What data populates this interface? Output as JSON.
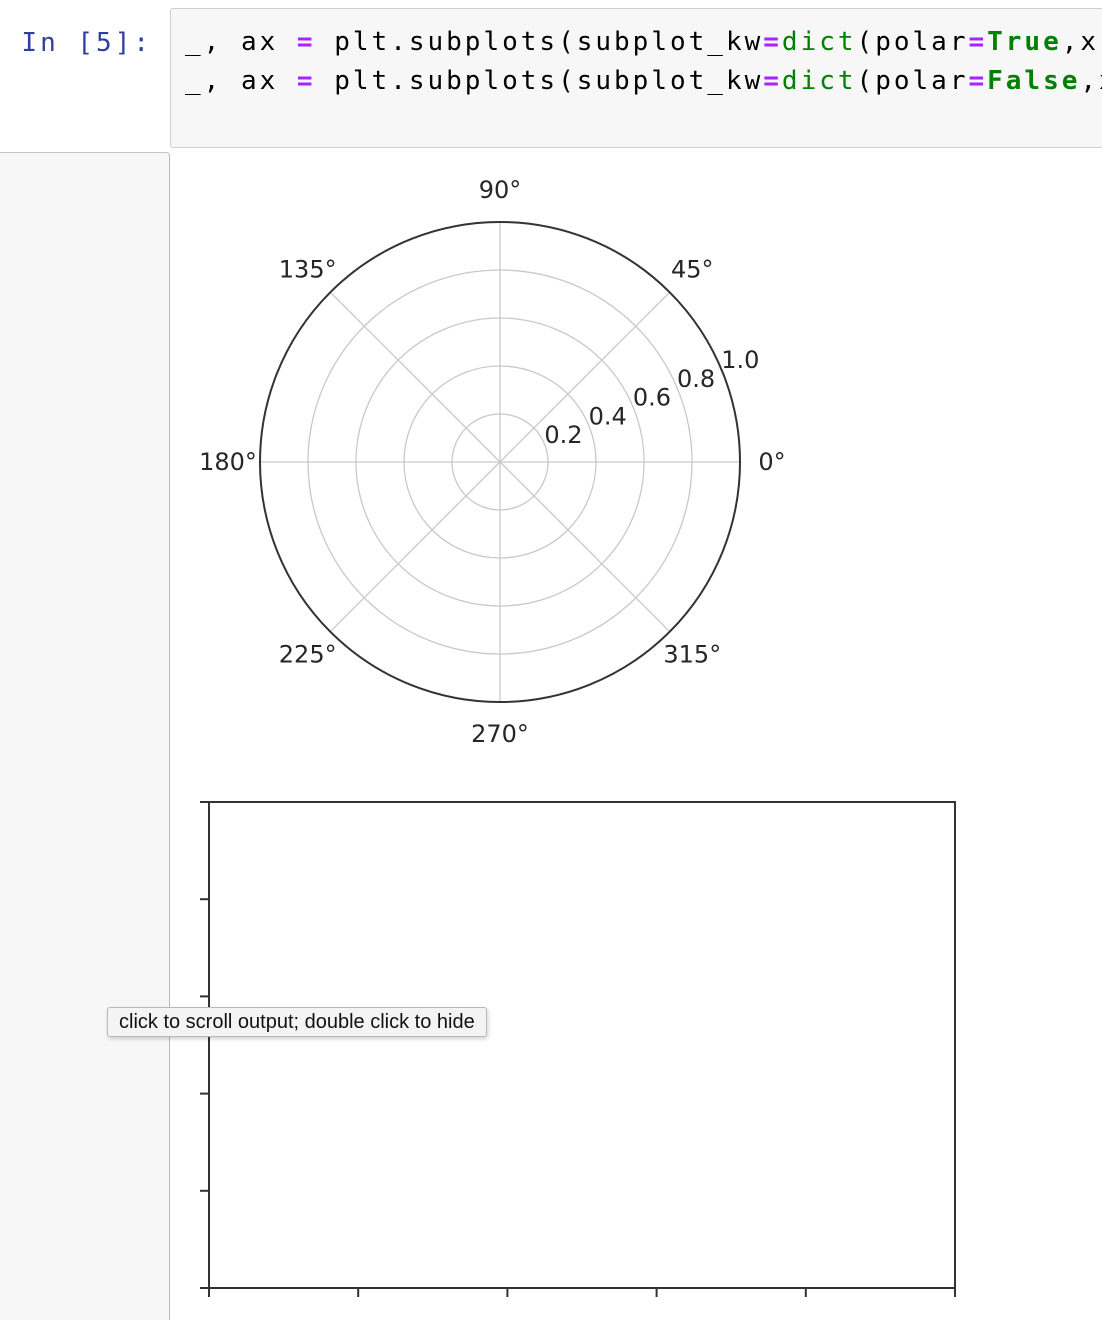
{
  "cell": {
    "prompt": "In [5]:",
    "code_lines": [
      [
        {
          "t": "_, ax ",
          "c": "plain"
        },
        {
          "t": "=",
          "c": "op"
        },
        {
          "t": " plt.subplots(subplot_kw",
          "c": "plain"
        },
        {
          "t": "=",
          "c": "op"
        },
        {
          "t": "dict",
          "c": "builtin"
        },
        {
          "t": "(polar",
          "c": "plain"
        },
        {
          "t": "=",
          "c": "op"
        },
        {
          "t": "True",
          "c": "keyword"
        },
        {
          "t": ",x",
          "c": "plain"
        }
      ],
      [
        {
          "t": "_, ax ",
          "c": "plain"
        },
        {
          "t": "=",
          "c": "op"
        },
        {
          "t": " plt.subplots(subplot_kw",
          "c": "plain"
        },
        {
          "t": "=",
          "c": "op"
        },
        {
          "t": "dict",
          "c": "builtin"
        },
        {
          "t": "(polar",
          "c": "plain"
        },
        {
          "t": "=",
          "c": "op"
        },
        {
          "t": "False",
          "c": "keyword"
        },
        {
          "t": ",x",
          "c": "plain"
        }
      ]
    ]
  },
  "tooltip": {
    "text": "click to scroll output; double click to hide"
  },
  "colors": {
    "prompt_blue": "#303F9F",
    "operator_purple": "#AA22FF",
    "keyword_green": "#008000",
    "input_bg": "#f7f7f7",
    "input_border": "#cfcfcf",
    "plot_spine": "#333333",
    "plot_grid": "#c9c9c9",
    "plot_text": "#262626"
  },
  "chart_data": [
    {
      "type": "line",
      "projection": "polar",
      "title": "",
      "series": [],
      "theta_tick_labels": [
        "0°",
        "45°",
        "90°",
        "135°",
        "180°",
        "225°",
        "270°",
        "315°"
      ],
      "theta_ticks_deg": [
        0,
        45,
        90,
        135,
        180,
        225,
        270,
        315
      ],
      "r_tick_labels": [
        "0.2",
        "0.4",
        "0.6",
        "0.8",
        "1.0"
      ],
      "r_ticks": [
        0.2,
        0.4,
        0.6,
        0.8,
        1.0
      ],
      "rlim": [
        0,
        1
      ],
      "grid": true,
      "legend": false,
      "description": "empty matplotlib polar axes (polar=True)"
    },
    {
      "type": "line",
      "projection": "rectilinear",
      "title": "",
      "series": [],
      "xlim": [
        0,
        1
      ],
      "ylim": [
        0,
        1
      ],
      "x_ticks": [
        0.0,
        0.2,
        0.4,
        0.6,
        0.8,
        1.0
      ],
      "y_ticks": [
        0.0,
        0.2,
        0.4,
        0.6,
        0.8,
        1.0
      ],
      "tick_labels_visible": false,
      "grid": false,
      "legend": false,
      "description": "empty matplotlib rectilinear axes (polar=False)"
    }
  ]
}
